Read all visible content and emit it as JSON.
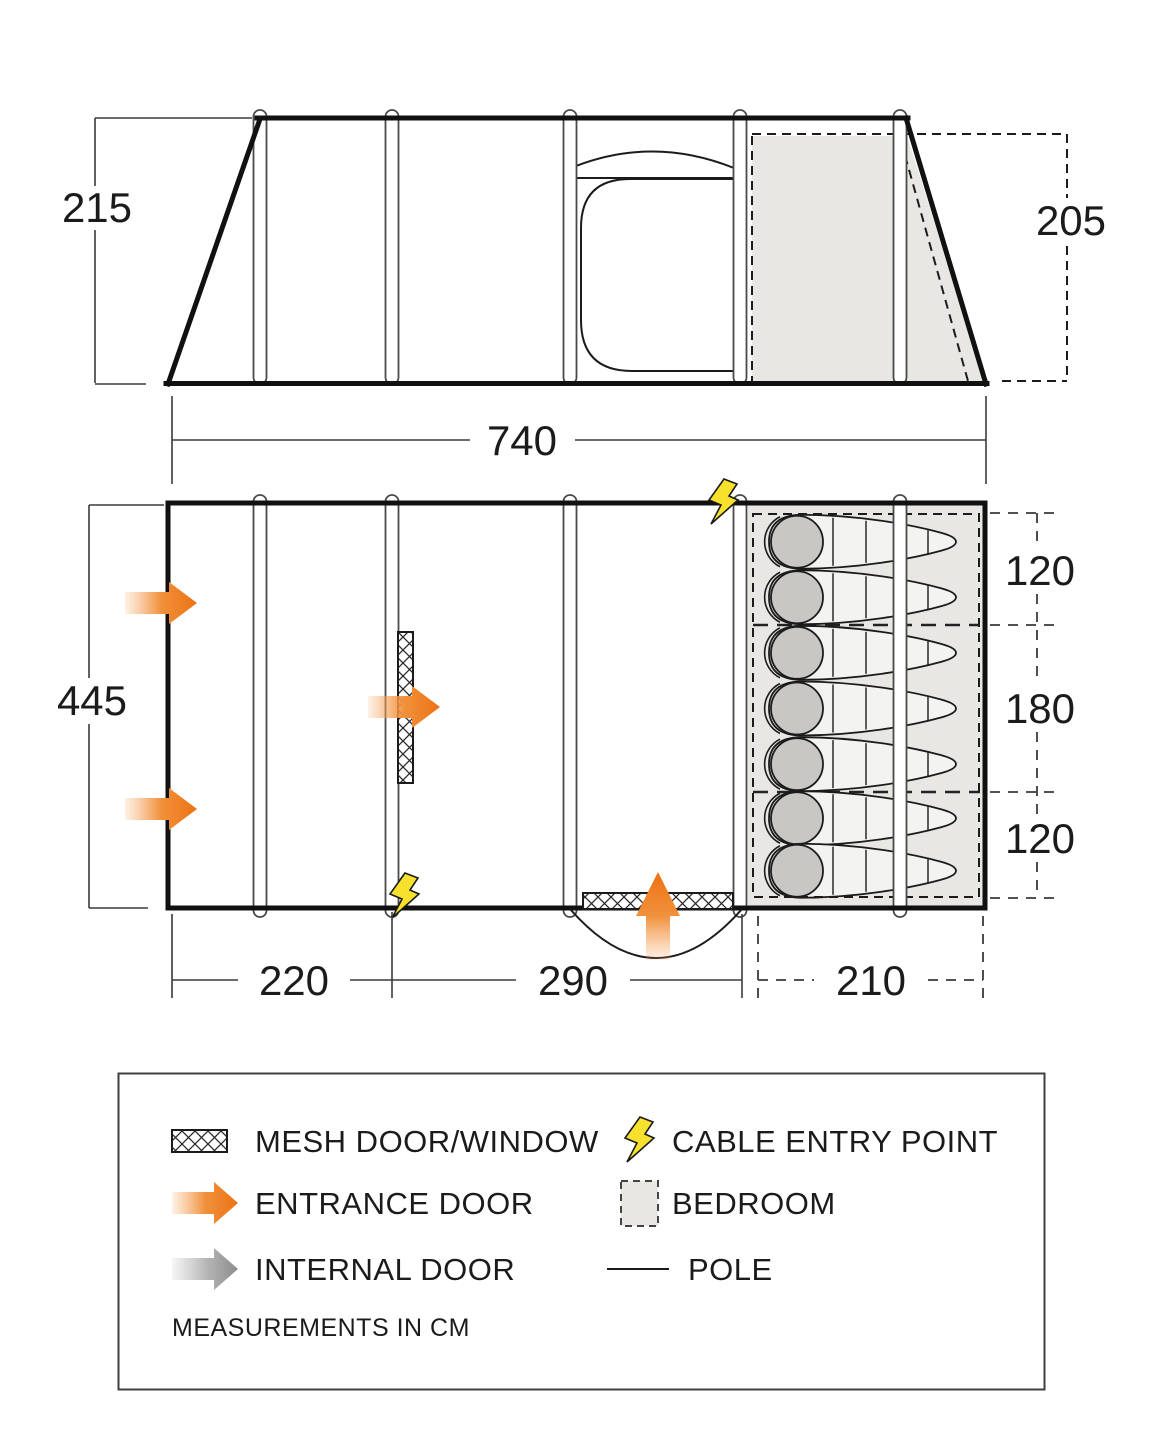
{
  "diagram": {
    "type": "tent-dimensions-floorplan",
    "units_note": "MEASUREMENTS IN CM",
    "side_view": {
      "height_left_cm": "215",
      "height_right_cm": "205",
      "length_cm": "740"
    },
    "floor_plan": {
      "width_cm": "445",
      "front_section_cm": "220",
      "living_section_cm": "290",
      "bedroom_depth_cm": "210",
      "bedroom_sections": [
        {
          "size_cm": "120",
          "sleeping_bags": 2
        },
        {
          "size_cm": "180",
          "sleeping_bags": 3
        },
        {
          "size_cm": "120",
          "sleeping_bags": 2
        }
      ],
      "entrance_doors": 3,
      "cable_entry_points": 2
    },
    "legend": {
      "items": [
        {
          "key": "mesh",
          "label": "MESH DOOR/WINDOW"
        },
        {
          "key": "cable",
          "label": "CABLE ENTRY POINT"
        },
        {
          "key": "entrance",
          "label": "ENTRANCE DOOR"
        },
        {
          "key": "bedroom",
          "label": "BEDROOM"
        },
        {
          "key": "internal",
          "label": "INTERNAL DOOR"
        },
        {
          "key": "pole",
          "label": "POLE"
        }
      ],
      "note": "MEASUREMENTS IN CM"
    },
    "colors": {
      "entrance_arrow": "#ed7215",
      "internal_arrow": "#8f8f8f",
      "cable_bolt": "#f7e12c",
      "bedroom_fill": "#e8e7e3",
      "line": "#1b1b1b"
    }
  }
}
